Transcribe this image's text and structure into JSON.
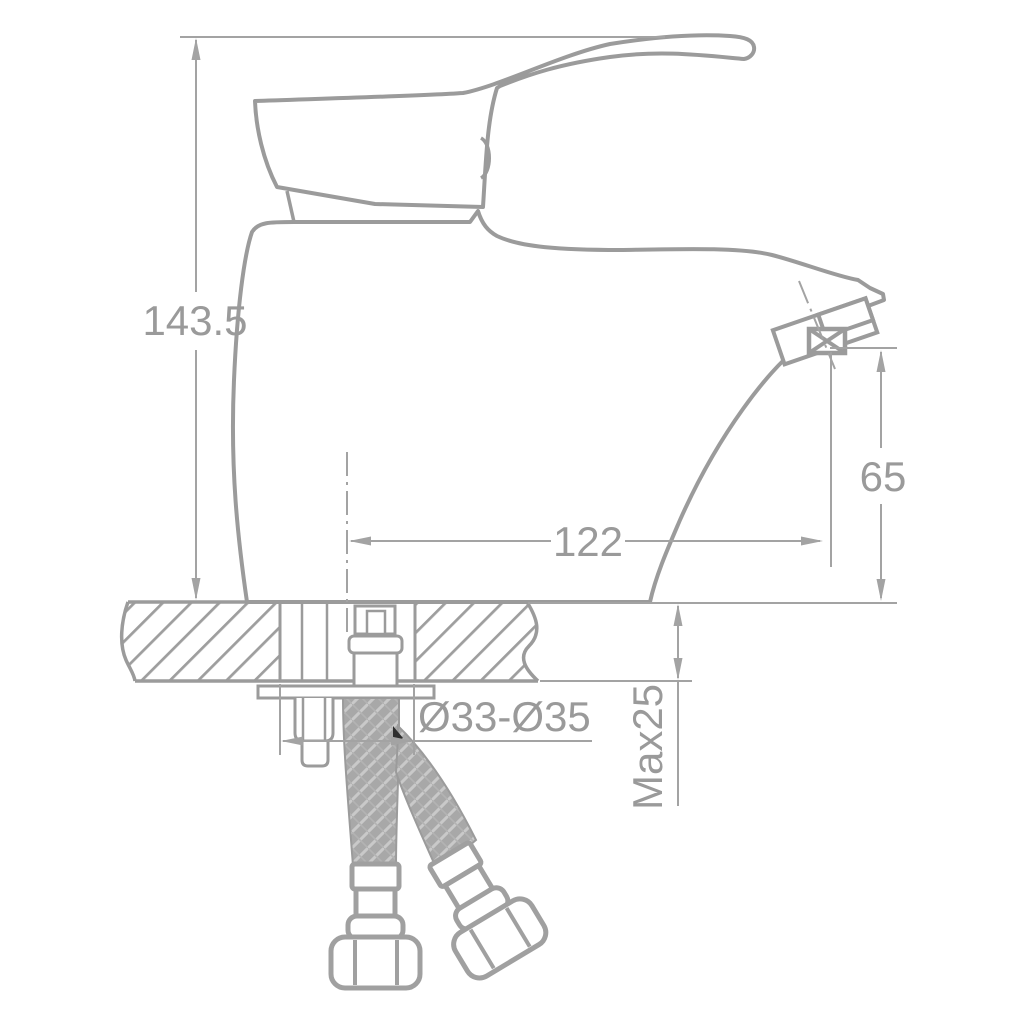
{
  "drawing": {
    "type": "faucet-technical-drawing",
    "background_color": "#ffffff",
    "line_color": "#9b9b9b",
    "dimension_line_color": "#a3a3a3",
    "text_color": "#9a9a9a",
    "hose_fill_color": "#a8a8a8",
    "hose_braid_color": "#c9c9c9",
    "dimensions": {
      "total_height": {
        "label": "143.5"
      },
      "spout_height": {
        "label": "65"
      },
      "spout_reach": {
        "label": "122"
      },
      "mounting_hole_diameter": {
        "label": "Ø33-Ø35"
      },
      "max_deck_thickness": {
        "label": "Max25"
      }
    }
  }
}
